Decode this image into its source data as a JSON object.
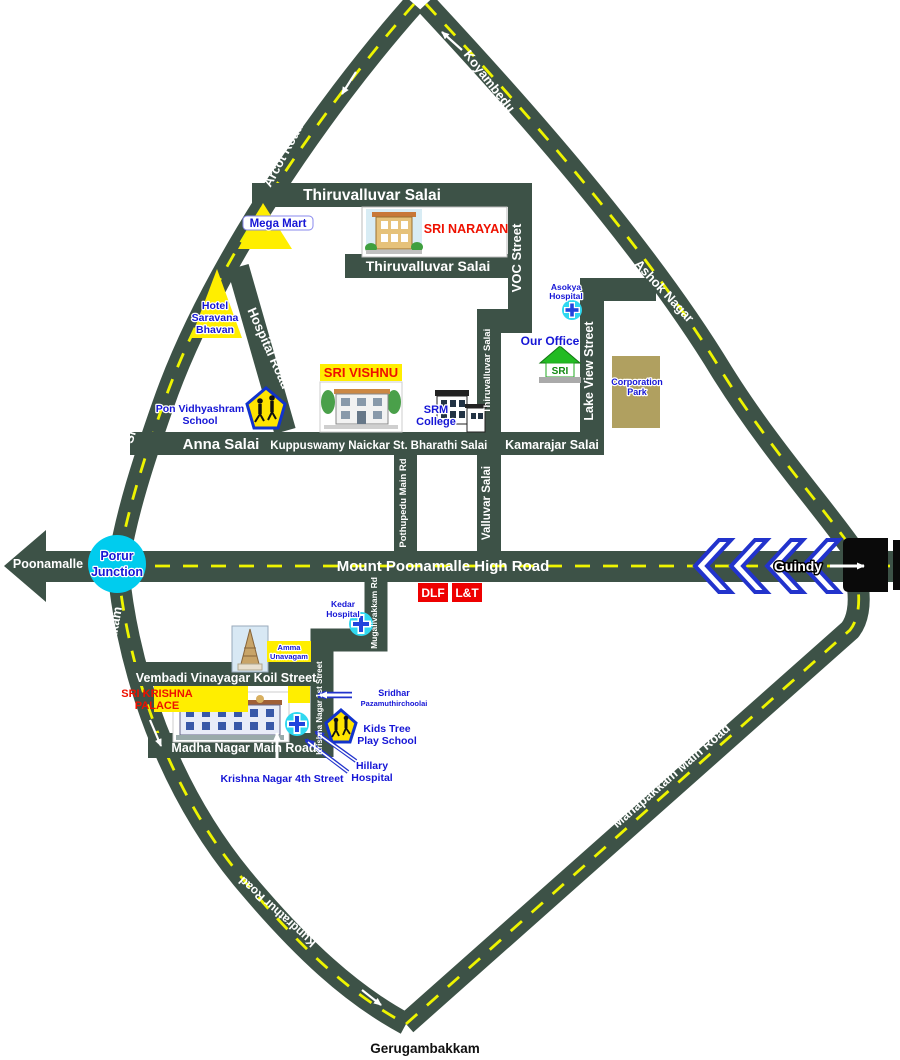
{
  "map_title": "Location map to Gerugambakkam / Madha Nagar area",
  "colors": {
    "road": "#3d5247",
    "lane_dash": "#eef400",
    "label_blue": "#1616d6",
    "label_red": "#ee1100",
    "junction_cyan": "#00ccee",
    "landmark_yellow": "#ffee00",
    "park_khaki": "#b0a060",
    "dlf_lnt_red": "#ee0000",
    "chevron_blue": "#2233cc"
  },
  "roads": {
    "arcot": "Arcot Road",
    "koyambedu": "Koyambedu",
    "sri_perumbudur": "Sri Perumbudur Road",
    "ashok_nagar": "Ashok Nagar",
    "gst": "G.S.T.Road",
    "kodambakkam": "Kodambakkam",
    "kundrathur": "Kundrathur Road",
    "manapakkam": "Manapakkam Main Road",
    "mount_poonamalle": "Mount Poonamalle High Road",
    "thiruvalluvar_top": "Thiruvalluvar Salai",
    "thiruvalluvar_mid": "Thiruvalluvar Salai",
    "thiruvalluvar_vert": "Thiruvalluvar Salai",
    "voc": "VOC Street",
    "lake_view": "Lake View Street",
    "hospital_road": "Hospital Road",
    "anna_salai": "Anna Salai",
    "kuppuswamy": "Kuppuswamy Naickar St.",
    "bharathi": "Bharathi Salai",
    "kamarajar": "Kamarajar Salai",
    "pothupedu": "Pothupedu Main Rd",
    "valluvar": "Valluvar Salai",
    "mugalivakkam": "Mugalivakkam Rd",
    "krishna_1st": "Krishna Nagar 1st Street",
    "krishna_4th": "Krishna Nagar 4th Street",
    "vembadi": "Vembadi Vinayagar Koil Street",
    "madha_nagar": "Madha Nagar Main Road"
  },
  "places": {
    "poonamalle": "Poonamalle",
    "porur_junction": [
      "Porur",
      "Junction"
    ],
    "guindy": "Guindy",
    "gerugambakkam": "Gerugambakkam"
  },
  "landmarks": {
    "mega_mart": "Mega Mart",
    "hotel_saravana_bhavan": [
      "Hotel",
      "Saravana",
      "Bhavan"
    ],
    "pon_vidhyashram_school": [
      "Pon Vidhyashram",
      "School"
    ],
    "sri_narayan": "SRI NARAYAN",
    "sri_vishnu": "SRI VISHNU",
    "srm_college": [
      "SRM",
      "College"
    ],
    "asokya_hospital": [
      "Asokya",
      "Hospital"
    ],
    "our_office": "Our Office",
    "corporation_park": [
      "Corporation",
      "Park"
    ],
    "dlf": "DLF",
    "lnt": "L&T",
    "kedar_hospital": [
      "Kedar",
      "Hospital"
    ],
    "amma_unavagam": [
      "Amma",
      "Unavagam"
    ],
    "sri_krishna_palace": [
      "SRI KRISHNA",
      "PALACE"
    ],
    "sridhar_pazamuthirchoolai": [
      "Sridhar",
      "Pazamuthirchoolai"
    ],
    "kids_tree_play_school": [
      "Kids Tree",
      "Play School"
    ],
    "hillary_hospital": [
      "Hillary",
      "Hospital"
    ]
  },
  "icons": {
    "hospital_cross": "blue cross on cyan circle",
    "school_crossing_sign": "yellow pentagon with children",
    "our_office_house": "green house with SRI",
    "temple_gopuram": "gopuram tower",
    "direction_chevrons": "<<<<",
    "poonamalle_arrow": "left road arrow",
    "guindy_arrow": "right white arrow"
  }
}
